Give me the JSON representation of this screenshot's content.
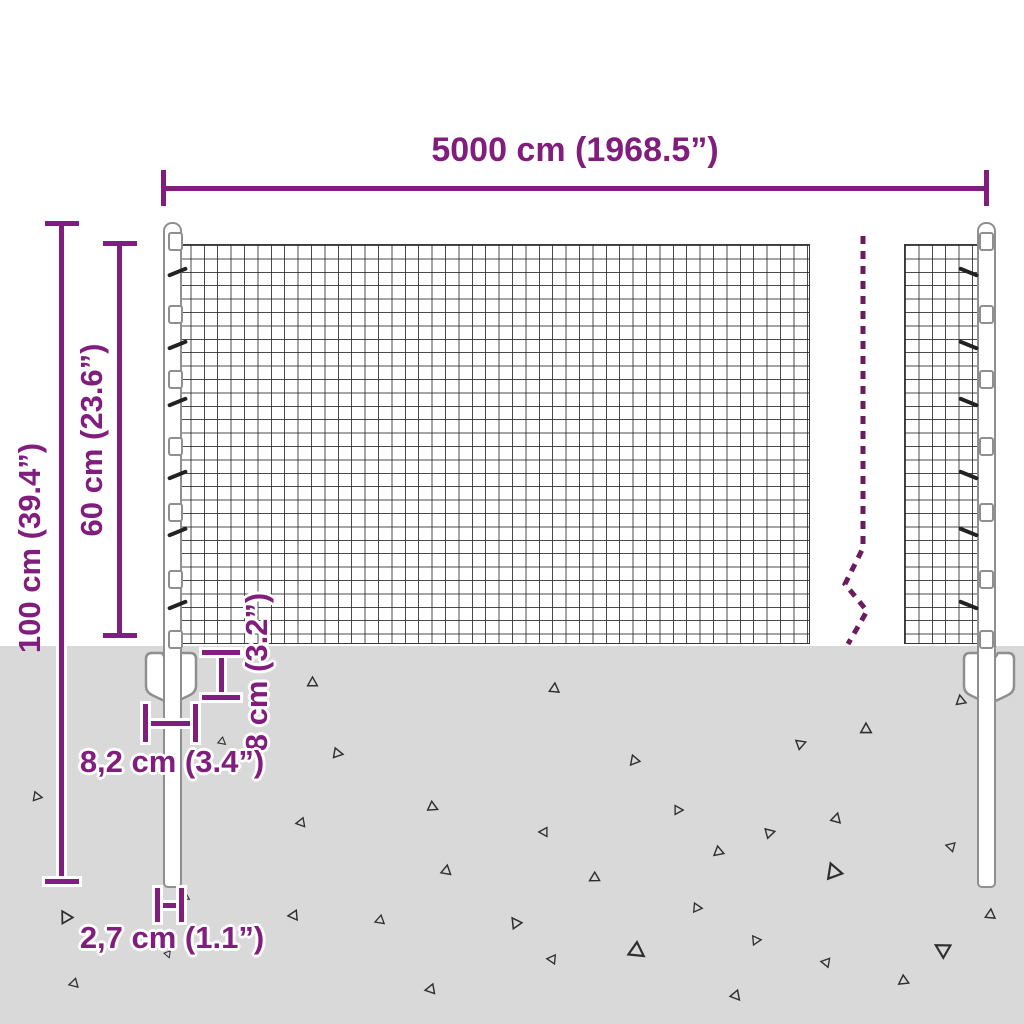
{
  "title": "Wire mesh fence dimension diagram",
  "dimensions": {
    "width": {
      "label": "5000 cm (1968.5”)"
    },
    "total_height": {
      "label": "100 cm (39.4”)"
    },
    "mesh_height": {
      "label": "60 cm (23.6”)"
    },
    "anchor_height": {
      "label": "8 cm (3.2”)"
    },
    "anchor_width": {
      "label": "8,2 cm (3.4”)"
    },
    "post_width": {
      "label": "2,7 cm (1.1”)"
    }
  },
  "colors": {
    "dimension_purple": "#811e7d",
    "dashed_break_line": "#6a1c5d",
    "ground_gray": "#d9d9d9",
    "mesh_wire": "#3a3a3a",
    "post_outline": "#8f8f8f",
    "triangle_outline": "#2e2e2e"
  },
  "ground": {
    "triangles": [
      [
        312,
        681,
        13,
        0
      ],
      [
        338,
        753,
        13,
        100
      ],
      [
        39,
        797,
        12,
        100
      ],
      [
        225,
        744,
        10,
        130
      ],
      [
        433,
        807,
        13,
        115
      ],
      [
        299,
        823,
        12,
        -100
      ],
      [
        446,
        869,
        13,
        10
      ],
      [
        65,
        916,
        16,
        -30
      ],
      [
        292,
        915,
        13,
        -95
      ],
      [
        378,
        921,
        12,
        -110
      ],
      [
        189,
        899,
        10,
        120
      ],
      [
        169,
        958,
        9,
        160
      ],
      [
        72,
        984,
        12,
        -105
      ],
      [
        429,
        989,
        13,
        -100
      ],
      [
        554,
        687,
        13,
        5
      ],
      [
        866,
        728,
        14,
        0
      ],
      [
        801,
        743,
        13,
        70
      ],
      [
        633,
        761,
        13,
        -140
      ],
      [
        960,
        699,
        13,
        -10
      ],
      [
        680,
        810,
        12,
        90
      ],
      [
        836,
        817,
        13,
        15
      ],
      [
        542,
        832,
        12,
        -90
      ],
      [
        770,
        832,
        13,
        75
      ],
      [
        717,
        852,
        13,
        -130
      ],
      [
        949,
        846,
        12,
        -75
      ],
      [
        833,
        870,
        20,
        -20
      ],
      [
        593,
        878,
        13,
        -120
      ],
      [
        699,
        908,
        12,
        95
      ],
      [
        515,
        922,
        14,
        -35
      ],
      [
        990,
        913,
        13,
        5
      ],
      [
        758,
        940,
        12,
        85
      ],
      [
        550,
        959,
        12,
        -85
      ],
      [
        638,
        952,
        20,
        125
      ],
      [
        824,
        962,
        12,
        -80
      ],
      [
        941,
        948,
        19,
        -60
      ],
      [
        902,
        981,
        13,
        -125
      ],
      [
        736,
        996,
        13,
        140
      ]
    ]
  },
  "posts": {
    "clip_ys": [
      232,
      305,
      370,
      437,
      503,
      570,
      630
    ],
    "hook_ys": [
      270,
      343,
      400,
      473,
      530,
      603
    ]
  }
}
